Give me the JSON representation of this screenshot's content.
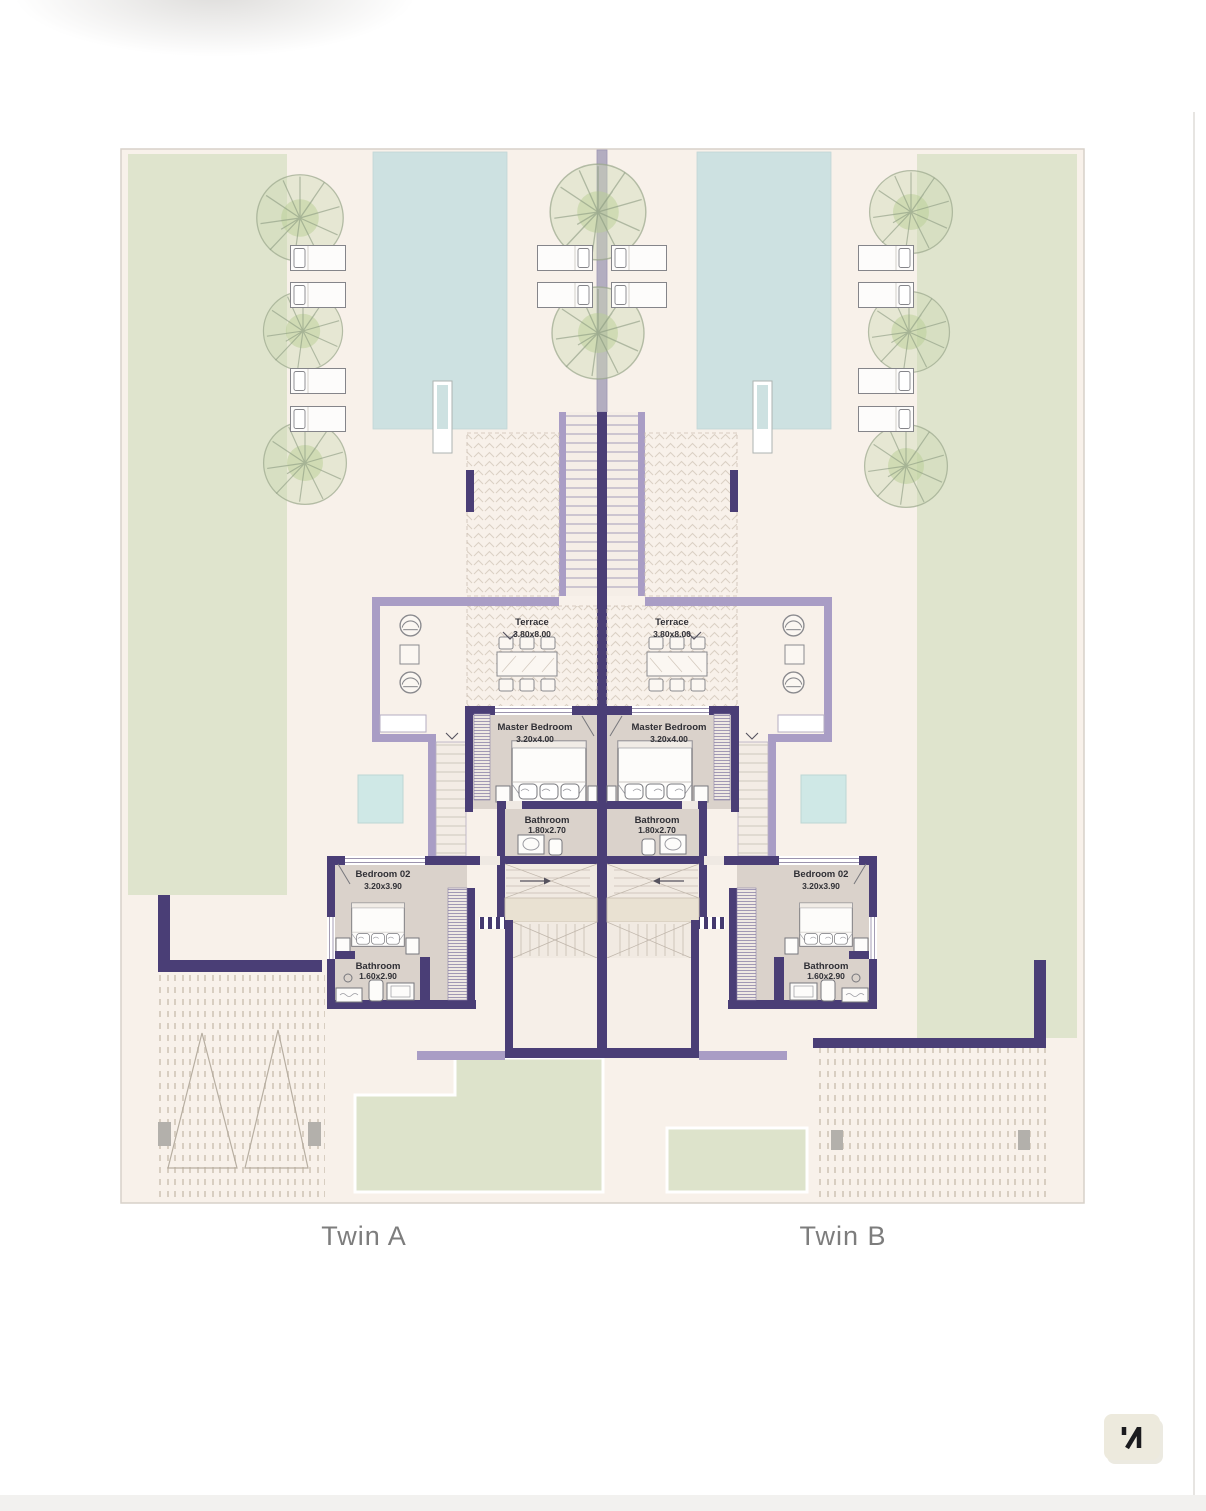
{
  "document": "floor-plan",
  "units": [
    {
      "label": "Twin A",
      "rooms": {
        "terrace": {
          "name": "Terrace",
          "dim": "3.80x8.00"
        },
        "master_bedroom": {
          "name": "Master Bedroom",
          "dim": "3.20x4.00"
        },
        "bathroom_master": {
          "name": "Bathroom",
          "dim": "1.80x2.70"
        },
        "bedroom_02": {
          "name": "Bedroom 02",
          "dim": "3.20x3.90"
        },
        "bathroom_02": {
          "name": "Bathroom",
          "dim": "1.60x2.90"
        }
      }
    },
    {
      "label": "Twin B",
      "rooms": {
        "terrace": {
          "name": "Terrace",
          "dim": "3.80x8.00"
        },
        "master_bedroom": {
          "name": "Master Bedroom",
          "dim": "3.20x4.00"
        },
        "bathroom_master": {
          "name": "Bathroom",
          "dim": "1.80x2.70"
        },
        "bedroom_02": {
          "name": "Bedroom 02",
          "dim": "3.20x3.90"
        },
        "bathroom_02": {
          "name": "Bathroom",
          "dim": "1.60x2.90"
        }
      }
    }
  ],
  "north_marker": {
    "icon": "north-arrow"
  },
  "colors": {
    "plan_background": "#f8f1ea",
    "wall_dark": "#4a3e76",
    "wall_light": "#a99dc5",
    "pool": "#cde1e1",
    "plunge_pool": "#cfe8e6",
    "lawn": "#dfe4cd",
    "room_floor": "#dad2cb",
    "label_gray": "#7d7d7d",
    "north_badge": "#edeadd"
  }
}
